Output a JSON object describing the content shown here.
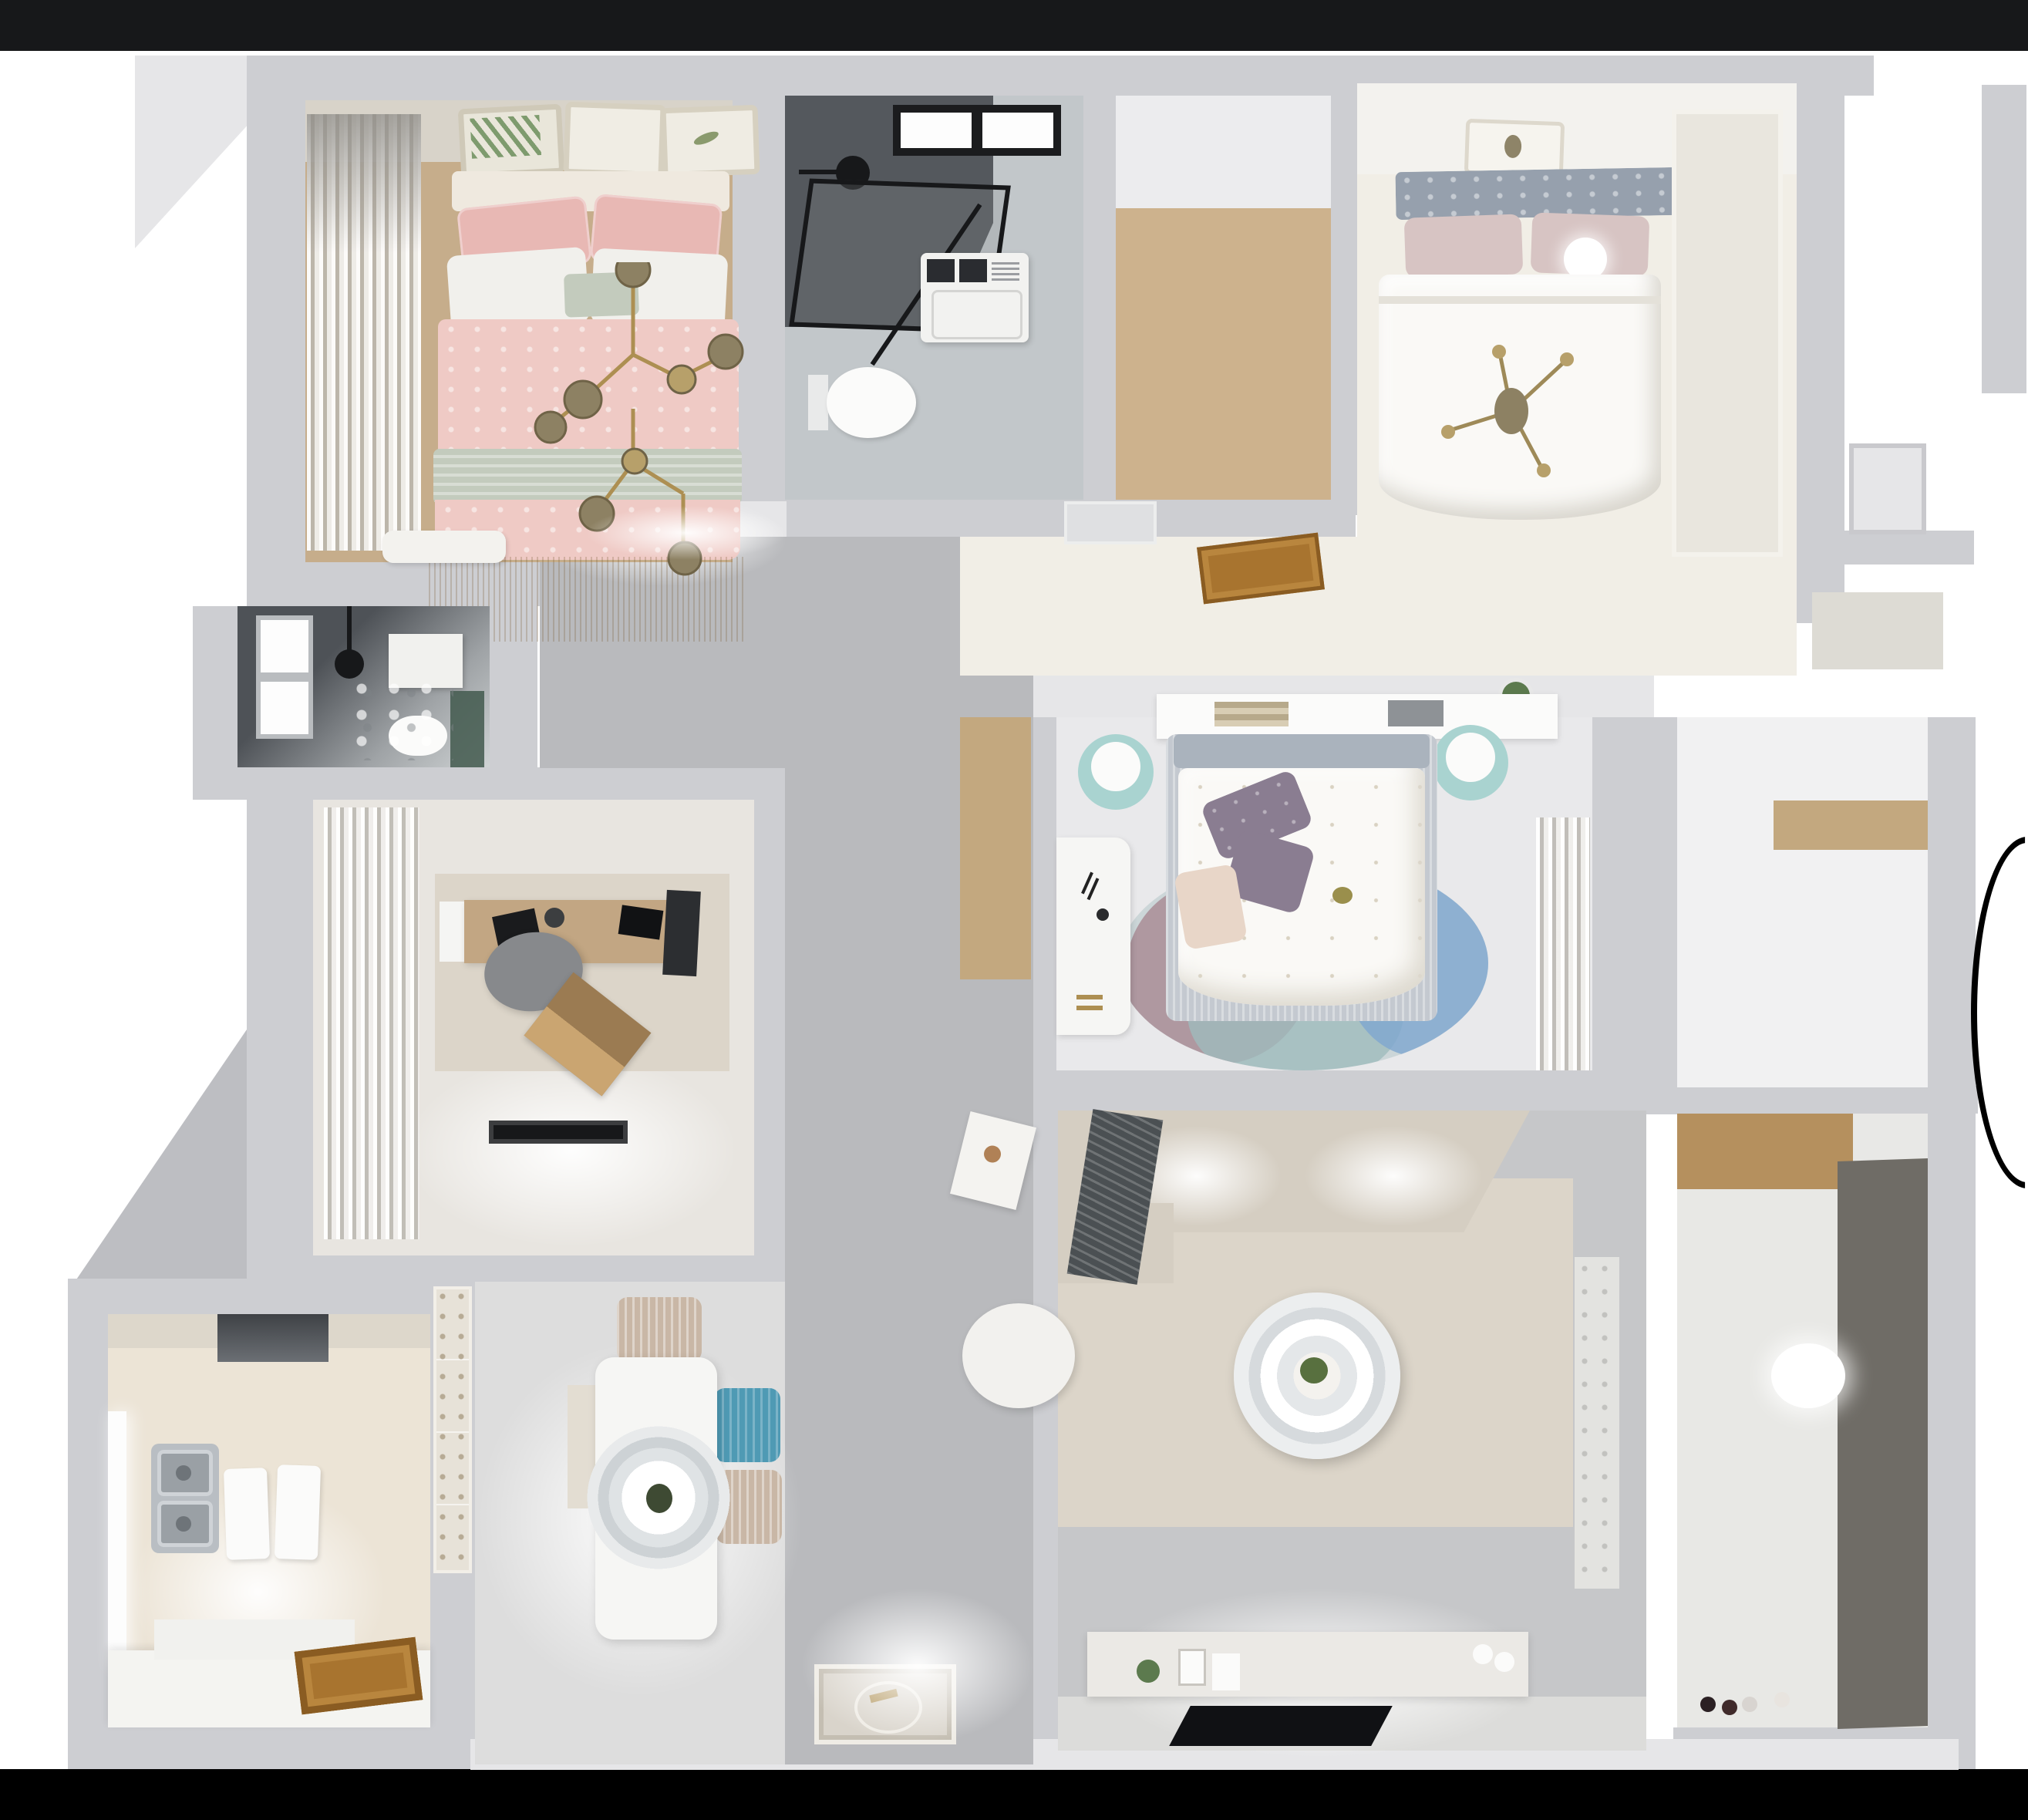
{
  "scene": {
    "kind": "3d-rendered-floor-plan-top-view",
    "description": "Dollhouse overhead render of a furnished apartment with two black letterbox bands",
    "background": "#ffffff",
    "letterbox": "#000000"
  },
  "palette": {
    "wall": "#cdced2",
    "wallLight": "#e6e6e8",
    "hallTile": "#b9babd",
    "livingTile": "#c6c7c9",
    "livingTileLight": "#dcdcda",
    "diningFloor": "#dddddd",
    "bedroom1Wood": "#c6ad8b",
    "closetWood": "#cdb28d",
    "nicheWood": "#c3a87f",
    "counterWood": "#b5905e",
    "doorBrown": "#a8742f",
    "pinkDuvet": "#efcac5",
    "pinkPillow": "#e8b8b4",
    "sageBlanket": "#c3cbbd",
    "whiteLinen": "#f1f0ec",
    "marble": "#c2c7ca",
    "showerDark": "#54585d",
    "fixtureBlack": "#17181a",
    "speckleFloor": "#f1eee6",
    "duvetWhite": "#faf9f6",
    "headboardGray": "#96a0ad",
    "blushPillow": "#d7c4c3",
    "wardrobeLouver": "#e9e6de",
    "bedroom3Floor": "#e9e9eb",
    "purplePillow": "#8a7d91",
    "tealStool": "#a9d3d0",
    "bedBaseGray": "#c4c9d0",
    "rugTeal": "#9fbcbd",
    "rugMauve": "#a98d96",
    "rugBlue": "#7ea6cf",
    "studyFloor": "#e8e5e0",
    "deskWood": "#c2a683",
    "chairGray": "#87898c",
    "trayWood": "#9b7b52",
    "kitchenHex": "#ece4d6",
    "steel": "#b9bec3",
    "tableWhite": "#f6f6f4",
    "chairBlue": "#4f9ab4",
    "chairBeige": "#c9b7a6",
    "sofaBeige": "#d5cec2",
    "throwDark": "#4b5053",
    "livingRug": "#dcd5c9",
    "consoleWhite": "#ebe9e5",
    "tvBlack": "#101114",
    "blindsTaupe": "#6f6c66",
    "balconyFloor": "#e8e8e5",
    "gold": "#ad8f52",
    "matBeige": "#d9d4cb",
    "greenPlant": "#5c7a4e",
    "accentGreen": "#42594e"
  },
  "rooms": [
    {
      "id": "bedroom-pink",
      "name": "secondary bedroom",
      "floor": "wood",
      "furniture": [
        "double bed with pink and sage bedding",
        "white pillows",
        "gold branch chandelier",
        "three wall art frames",
        "gray curtains",
        "white foot bench"
      ]
    },
    {
      "id": "bathroom-main",
      "name": "main bathroom",
      "floor": "gray marble",
      "furniture": [
        "black framed walk-in shower",
        "black window",
        "washing machine",
        "wall hung toilet"
      ]
    },
    {
      "id": "walk-in-closet",
      "name": "walk-in closet",
      "floor": "light oak planks",
      "furniture": []
    },
    {
      "id": "bedroom-master",
      "name": "master bedroom",
      "floor": "confetti speckle",
      "furniture": [
        "gray upholstered bed",
        "white duvet",
        "blush pillows",
        "sphere lamp",
        "gold cross chandelier",
        "louvered wardrobe",
        "art frame"
      ]
    },
    {
      "id": "shower-room",
      "name": "dark shower room",
      "floor": "marble with green accents",
      "furniture": [
        "window",
        "toilet",
        "tissue box",
        "black shower set"
      ]
    },
    {
      "id": "study",
      "name": "study",
      "floor": "pale screed",
      "furniture": [
        "wood desk",
        "dark gray chair",
        "laptop tray",
        "white curtains",
        "mottled rug",
        "black doormat"
      ]
    },
    {
      "id": "bedroom-kids",
      "name": "middle bedroom",
      "floor": "pale tile",
      "furniture": [
        "canopy shelf bed",
        "purple pillows",
        "round color-block rug",
        "white desk",
        "two teal stools",
        "sheer curtains"
      ]
    },
    {
      "id": "kitchen",
      "name": "kitchen",
      "floor": "patterned hex tile",
      "furniture": [
        "double steel sink",
        "white counters",
        "range hood",
        "wooden entry door",
        "window"
      ]
    },
    {
      "id": "dining",
      "name": "dining nook",
      "floor": "light gray",
      "furniture": [
        "white dining table",
        "ring pendant lamp",
        "blue chair",
        "two beige chairs",
        "wall bench"
      ]
    },
    {
      "id": "living",
      "name": "living room",
      "floor": "gray tile",
      "furniture": [
        "L-shaped beige sofa",
        "dark throw",
        "round two-tier coffee table",
        "white pouf",
        "tilted side table",
        "TV sideboard",
        "flat TV on floor pad"
      ]
    },
    {
      "id": "hallway",
      "name": "hallway",
      "floor": "large gray tiles",
      "furniture": [
        "ornate entry mat",
        "air vent grille",
        "brown door mat",
        "potted plant"
      ]
    },
    {
      "id": "balcony",
      "name": "laundry balcony",
      "floor": "motif tile",
      "furniture": [
        "wood laundry counter",
        "white cabinet",
        "dark drying blinds",
        "glow lamp",
        "floor toys"
      ]
    },
    {
      "id": "corridor-right",
      "name": "entry corridor",
      "floor": "white screed",
      "furniture": [
        "white door",
        "louvered shoe cabinet",
        "wood niche shelf"
      ]
    }
  ]
}
